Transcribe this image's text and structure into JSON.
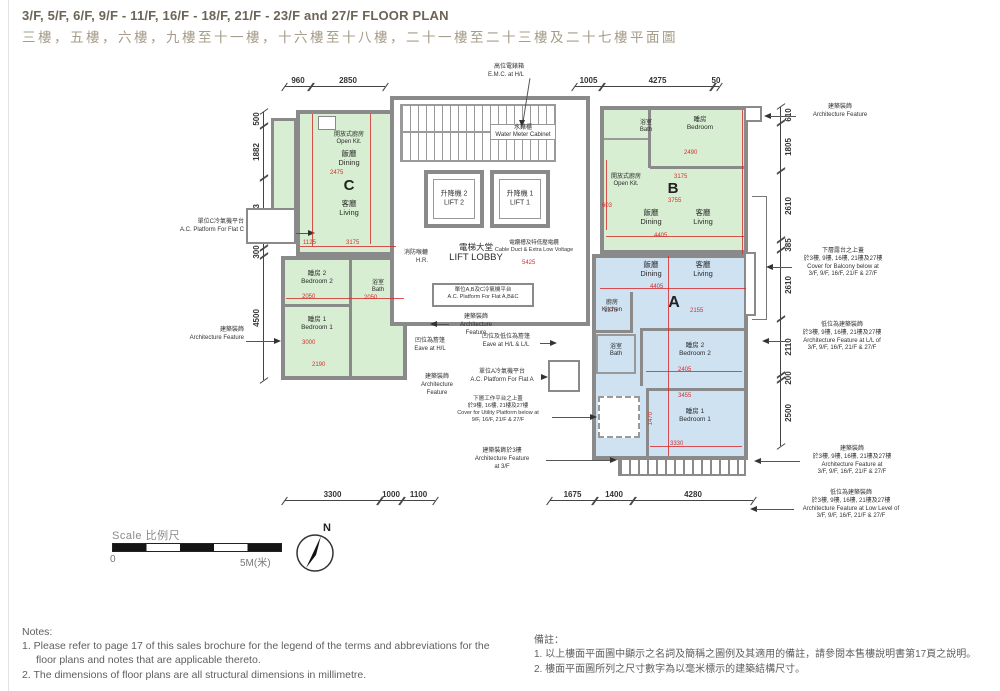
{
  "page": {
    "title_en": "3/F, 5/F, 6/F, 9/F - 11/F, 16/F - 18/F, 21/F - 23/F and 27/F FLOOR PLAN",
    "title_zh": "三樓，五樓，六樓，九樓至十一樓，十六樓至十八樓，二十一樓至二十三樓及二十七樓平面圖"
  },
  "flats": {
    "a": "A",
    "b": "B",
    "c": "C"
  },
  "rooms": {
    "dining_zh": "飯廳",
    "dining_en": "Dining",
    "living_zh": "客廳",
    "living_en": "Living",
    "bedroom_zh": "睡房",
    "bedroom_en": "Bedroom",
    "bedroom1_zh": "睡房 1",
    "bedroom1_en": "Bedroom 1",
    "bedroom2_zh": "睡房 2",
    "bedroom2_en": "Bedroom 2",
    "bath_zh": "浴室",
    "bath_en": "Bath",
    "kitchen_zh": "廚房",
    "kitchen_en": "Kitchen",
    "openkit_zh": "開放式廚房",
    "openkit_en": "Open Kit."
  },
  "core": {
    "lift1_zh": "升降機 1",
    "lift1_en": "LIFT 1",
    "lift2_zh": "升降機 2",
    "lift2_en": "LIFT 2",
    "lobby_zh": "電梯大堂",
    "lobby_en": "LIFT LOBBY",
    "water_zh": "水錶櫃",
    "water_en": "Water Meter Cabinet",
    "hr_zh": "消防喉轆",
    "hr_en": "H.R.",
    "cable_zh": "電纜槽及特低壓電纜",
    "cable_en": "Cable Duct & Extra Low Voltage",
    "emc_zh": "高位電錶箱",
    "emc_en": "E.M.C. at H/L"
  },
  "annotations": {
    "ac_c_zh": "單位C冷氣機平台",
    "ac_c_en": "A.C. Platform For Flat C",
    "af_zh": "建築裝飾",
    "af_en": "Architecture Feature",
    "af_en1": "Architecture",
    "af_en2": "Feature",
    "ac_abc_zh": "單位A,B及C冷氣機平台",
    "ac_abc_en": "A.C. Platform For Flat A,B&C",
    "eave_hl_zh": "凹位為簷篷",
    "eave_hl_en": "Eave at H/L",
    "eave_hll_zh": "凹位及低位為簷篷",
    "eave_hll_en": "Eave at H/L & L/L",
    "ac_a_zh": "單位A冷氣機平台",
    "ac_a_en": "A.C. Platform For Flat A",
    "utility_zh1": "下層工作平台之上蓋",
    "utility_zh2": "於9樓, 16樓, 21樓及27樓",
    "utility_en1": "Cover for Utility Platform below at",
    "utility_en2": "9/F, 16/F, 21/F & 27/F",
    "af3f_zh": "建築裝飾於3樓",
    "af3f_en1": "Architecture Feature",
    "af3f_en2": "at 3/F",
    "balcony_zh1": "下層露台之上蓋",
    "balcony_zh2": "於3樓, 9樓, 16樓, 21樓及27樓",
    "balcony_en1": "Cover for Balcony below at",
    "balcony_en2": "3/F, 9/F, 16/F, 21/F & 27/F",
    "af_ll_zh1": "低位為建築裝飾",
    "af_ll_zh2": "於3樓, 9樓, 16樓, 21樓及27樓",
    "af_ll_en1": "Architecture Feature at L/L of",
    "af_ll_en2": "3/F, 9/F, 16/F, 21/F & 27/F",
    "af_floors_zh1": "建築裝飾",
    "af_floors_zh2": "於3樓, 9樓, 16樓, 21樓及27樓",
    "af_floors_en1": "Architecture Feature at",
    "af_floors_en2": "3/F, 9/F, 16/F, 21/F & 27/F",
    "af_low_zh1": "低位為建築裝飾",
    "af_low_zh2": "於3樓, 9樓, 16樓, 21樓及27樓",
    "af_low_en1": "Architecture Feature at Low Level of",
    "af_low_en2": "3/F, 9/F, 16/F, 21/F & 27/F"
  },
  "dims": {
    "top_left": [
      "960",
      "2850"
    ],
    "top_right": [
      "1005",
      "4275",
      "50"
    ],
    "left": [
      "500",
      "1882",
      "2543",
      "300",
      "4500"
    ],
    "right": [
      "610",
      "1805",
      "2610",
      "385",
      "2610",
      "2110",
      "200",
      "2500"
    ],
    "bottom_left": [
      "3300",
      "1000",
      "1100"
    ],
    "bottom_right": [
      "1675",
      "1400",
      "4280"
    ]
  },
  "red_dims": {
    "c_dining_w": "2475",
    "c1": "1125",
    "c2": "3175",
    "c_bed2_w": "2050",
    "c_bed1_w": "3000",
    "c_bed1_w2": "2190",
    "c_bath_w": "2050",
    "b_bed_w": "2490",
    "b1": "3175",
    "b2": "3755",
    "b_lr_w": "4405",
    "b3": "603",
    "a_lr_w": "4405",
    "a1": "2155",
    "a2": "1375",
    "a_bed2_w": "2405",
    "a_bed1_w": "3455",
    "a_bed1_w2": "3330",
    "a3": "1470",
    "lobby": "5425"
  },
  "scalebar": {
    "label_en": "Scale",
    "label_zh": "比例尺",
    "zero": "0",
    "five": "5M(米)",
    "north": "N"
  },
  "notes_en": {
    "title": "Notes:",
    "items": [
      "1.  Please refer to page 17 of this sales brochure for the legend of the terms and abbreviations for the floor plans and notes that are applicable thereto.",
      "2.  The dimensions of floor plans are all structural dimensions in millimetre."
    ]
  },
  "notes_zh": {
    "title": "備註：",
    "items": [
      "1.  以上樓面平面圖中顯示之名詞及簡稱之圖例及其適用的備註，請參閱本售樓說明書第17頁之說明。",
      "2.  樓面平面圖所列之尺寸數字為以毫米標示的建築結構尺寸。"
    ]
  }
}
